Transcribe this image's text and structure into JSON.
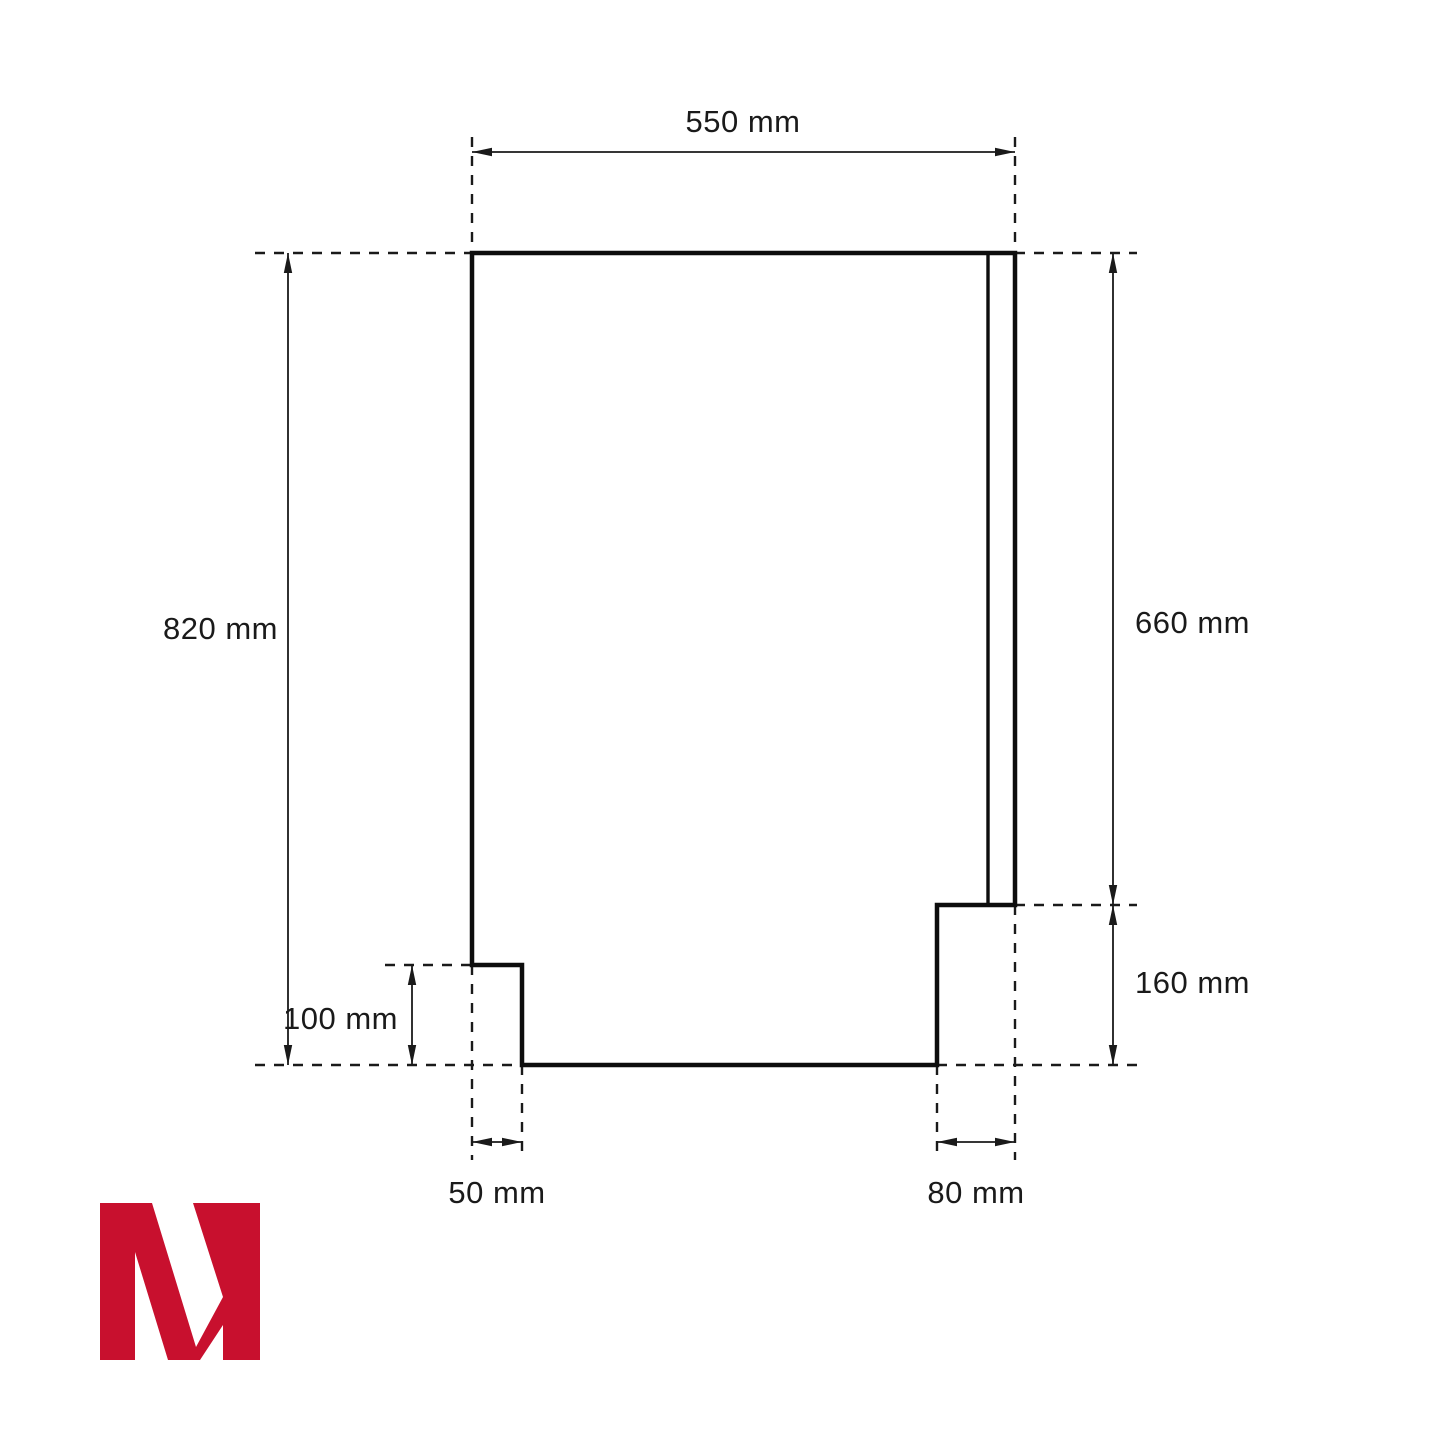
{
  "diagram": {
    "type": "technical dimension drawing",
    "units": "mm",
    "dimensions": {
      "top_width": {
        "label": "550 mm",
        "value": 550,
        "unit": "mm"
      },
      "left_height": {
        "label": "820 mm",
        "value": 820,
        "unit": "mm"
      },
      "right_height": {
        "label": "660 mm",
        "value": 660,
        "unit": "mm"
      },
      "right_step_height": {
        "label": "160 mm",
        "value": 160,
        "unit": "mm"
      },
      "left_notch_height": {
        "label": "100 mm",
        "value": 100,
        "unit": "mm"
      },
      "left_notch_width": {
        "label": "50 mm",
        "value": 50,
        "unit": "mm"
      },
      "right_step_width": {
        "label": "80 mm",
        "value": 80,
        "unit": "mm"
      }
    },
    "colors": {
      "line": "#1a1a1a",
      "background": "#ffffff",
      "logo_red": "#c8102e"
    },
    "logo": {
      "letter": "M"
    }
  }
}
